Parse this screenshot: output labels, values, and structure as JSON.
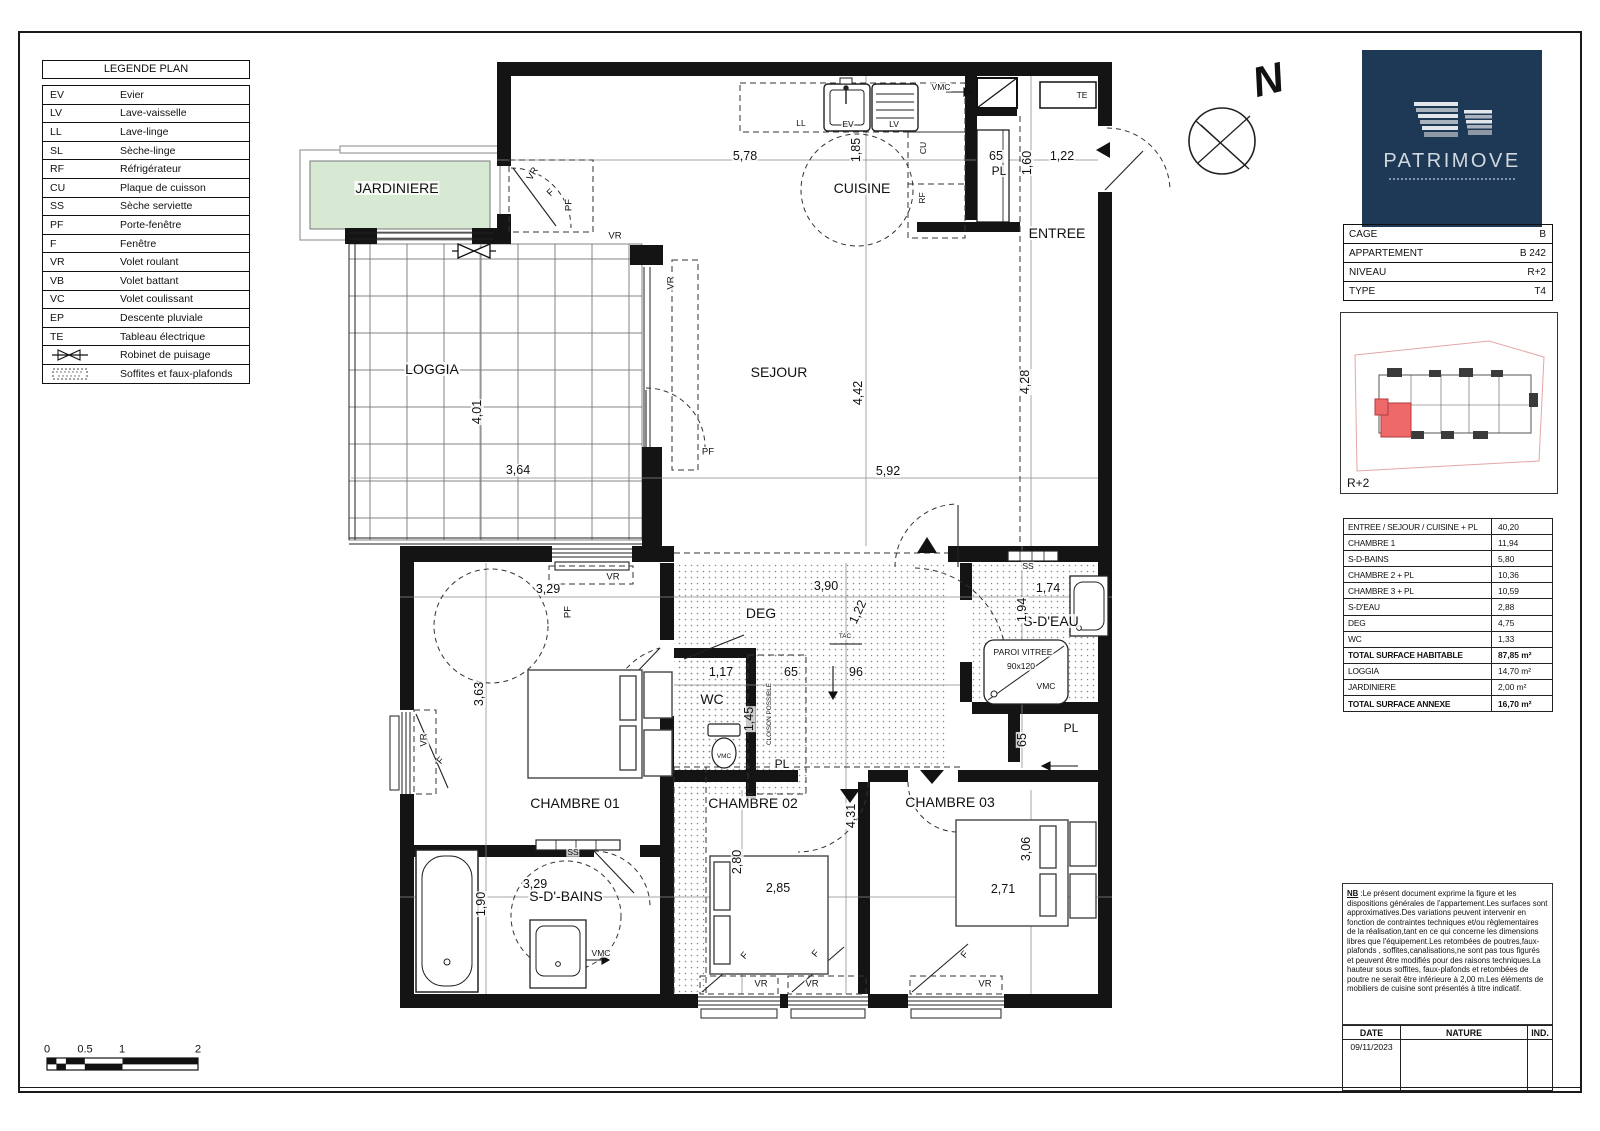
{
  "legend": {
    "title": "LEGENDE PLAN",
    "rows": [
      {
        "code": "EV",
        "label": "Evier"
      },
      {
        "code": "LV",
        "label": "Lave-vaisselle"
      },
      {
        "code": "LL",
        "label": "Lave-linge"
      },
      {
        "code": "SL",
        "label": "Sèche-linge"
      },
      {
        "code": "RF",
        "label": "Réfrigérateur"
      },
      {
        "code": "CU",
        "label": "Plaque de cuisson"
      },
      {
        "code": "SS",
        "label": "Sèche serviette"
      },
      {
        "code": "PF",
        "label": "Porte-fenêtre"
      },
      {
        "code": "F",
        "label": "Fenêtre"
      },
      {
        "code": "VR",
        "label": "Volet roulant"
      },
      {
        "code": "VB",
        "label": "Volet battant"
      },
      {
        "code": "VC",
        "label": "Volet coulissant"
      },
      {
        "code": "EP",
        "label": "Descente pluviale"
      },
      {
        "code": "TE",
        "label": "Tableau électrique"
      }
    ],
    "robinet_label": "Robinet de puisage",
    "soffites_label": "Soffites et faux-plafonds"
  },
  "compass": {
    "letter": "N"
  },
  "logo": {
    "brand": "PATRIMOVE"
  },
  "info": {
    "rows": [
      {
        "label": "CAGE",
        "value": "B"
      },
      {
        "label": "APPARTEMENT",
        "value": "B 242"
      },
      {
        "label": "NIVEAU",
        "value": "R+2"
      },
      {
        "label": "TYPE",
        "value": "T4"
      }
    ]
  },
  "keyplan": {
    "level": "R+2"
  },
  "surfaces": {
    "rows": [
      {
        "label": "ENTREE / SEJOUR / CUISINE + PL",
        "value": "40,20"
      },
      {
        "label": "CHAMBRE 1",
        "value": "11,94"
      },
      {
        "label": "S-D-BAINS",
        "value": "5,80"
      },
      {
        "label": "CHAMBRE 2 + PL",
        "value": "10,36"
      },
      {
        "label": "CHAMBRE 3 + PL",
        "value": "10,59"
      },
      {
        "label": "S-D'EAU",
        "value": "2,88"
      },
      {
        "label": "DEG",
        "value": "4,75"
      },
      {
        "label": "WC",
        "value": "1,33"
      },
      {
        "label": "TOTAL SURFACE HABITABLE",
        "value": "87,85 m²",
        "cls": "b"
      },
      {
        "label": "LOGGIA",
        "value": "14,70 m²"
      },
      {
        "label": "JARDINIERE",
        "value": "2,00 m²"
      },
      {
        "label": "TOTAL SURFACE ANNEXE",
        "value": "16,70 m²",
        "cls": "b"
      }
    ]
  },
  "nb": {
    "prefix": "NB",
    "text": " :Le présent document exprime la figure et les dispositions générales de l'appartement.Les surfaces sont approximatives.Des variations peuvent intervenir en fonction de contraintes techniques et/ou règlementaires de la réalisation,tant en ce qui concerne les dimensions libres que l'équipement.Les retombées de poutres,faux-plafonds , soffites,canalisations,ne sont pas tous figurés et peuvent être modifiés pour des raisons techniques.La hauteur sous soffites, faux-plafonds et retombées de poutre ne serait être inférieure à 2,00 m.Les éléments de mobiliers de cuisine sont présentés à titre indicatif."
  },
  "revisions": {
    "headers": [
      "DATE",
      "NATURE",
      "IND."
    ],
    "date": "09/11/2023"
  },
  "scalebar": {
    "ticks": [
      {
        "t": "0",
        "x": 47,
        "y": 1050
      },
      {
        "t": "0.5",
        "x": 85,
        "y": 1050
      },
      {
        "t": "1",
        "x": 122,
        "y": 1050
      },
      {
        "t": "2",
        "x": 198,
        "y": 1050
      }
    ]
  },
  "plan": {
    "labels": [
      {
        "t": "JARDINIERE",
        "x": 397,
        "y": 188,
        "c": "room"
      },
      {
        "t": "CUISINE",
        "x": 862,
        "y": 188,
        "c": "room"
      },
      {
        "t": "ENTREE",
        "x": 1057,
        "y": 233,
        "c": "room"
      },
      {
        "t": "SEJOUR",
        "x": 779,
        "y": 372,
        "c": "room"
      },
      {
        "t": "LOGGIA",
        "x": 432,
        "y": 369,
        "c": "room"
      },
      {
        "t": "DEG",
        "x": 761,
        "y": 613,
        "c": "room"
      },
      {
        "t": "S-D'EAU",
        "x": 1051,
        "y": 621,
        "c": "room"
      },
      {
        "t": "WC",
        "x": 712,
        "y": 699,
        "c": "room"
      },
      {
        "t": "CHAMBRE 01",
        "x": 575,
        "y": 803,
        "c": "room"
      },
      {
        "t": "CHAMBRE 02",
        "x": 753,
        "y": 803,
        "c": "room"
      },
      {
        "t": "CHAMBRE 03",
        "x": 950,
        "y": 802,
        "c": "room"
      },
      {
        "t": "S-D'-BAINS",
        "x": 566,
        "y": 896,
        "c": "room"
      },
      {
        "t": "PL",
        "x": 999,
        "y": 171,
        "c": "rsm"
      },
      {
        "t": "PL",
        "x": 782,
        "y": 764,
        "c": "rsm"
      },
      {
        "t": "PL",
        "x": 1071,
        "y": 728,
        "c": "rsm"
      },
      {
        "t": "5,78",
        "x": 745,
        "y": 156,
        "c": "dim"
      },
      {
        "t": "1,85",
        "x": 856,
        "y": 150,
        "r": -90,
        "c": "dim"
      },
      {
        "t": "65",
        "x": 996,
        "y": 156,
        "c": "dim"
      },
      {
        "t": "1,60",
        "x": 1027,
        "y": 163,
        "r": -90,
        "c": "dim"
      },
      {
        "t": "1,22",
        "x": 1062,
        "y": 156,
        "c": "dim"
      },
      {
        "t": "4,42",
        "x": 858,
        "y": 393,
        "r": -90,
        "c": "dim"
      },
      {
        "t": "4,28",
        "x": 1025,
        "y": 382,
        "r": -90,
        "c": "dim"
      },
      {
        "t": "5,92",
        "x": 888,
        "y": 471,
        "c": "dim"
      },
      {
        "t": "4,01",
        "x": 477,
        "y": 412,
        "r": -90,
        "c": "dim"
      },
      {
        "t": "3,64",
        "x": 518,
        "y": 470,
        "c": "dim"
      },
      {
        "t": "3,29",
        "x": 548,
        "y": 589,
        "c": "dim"
      },
      {
        "t": "3,63",
        "x": 479,
        "y": 694,
        "r": -90,
        "c": "dim"
      },
      {
        "t": "3,90",
        "x": 826,
        "y": 586,
        "c": "dim"
      },
      {
        "t": "1,22",
        "x": 858,
        "y": 612,
        "r": -65,
        "c": "dim"
      },
      {
        "t": "1,74",
        "x": 1048,
        "y": 588,
        "c": "dim"
      },
      {
        "t": "1,94",
        "x": 1022,
        "y": 610,
        "r": -90,
        "c": "dim"
      },
      {
        "t": "1,17",
        "x": 721,
        "y": 672,
        "c": "dim"
      },
      {
        "t": "65",
        "x": 791,
        "y": 672,
        "c": "dim"
      },
      {
        "t": "96",
        "x": 856,
        "y": 672,
        "c": "dim"
      },
      {
        "t": "1,45",
        "x": 749,
        "y": 719,
        "r": -90,
        "c": "dim"
      },
      {
        "t": "65",
        "x": 1022,
        "y": 740,
        "r": -90,
        "c": "dim"
      },
      {
        "t": "3,29",
        "x": 535,
        "y": 884,
        "c": "dim"
      },
      {
        "t": "1,90",
        "x": 481,
        "y": 904,
        "r": -90,
        "c": "dim"
      },
      {
        "t": "2,80",
        "x": 737,
        "y": 862,
        "r": -90,
        "c": "dim"
      },
      {
        "t": "2,85",
        "x": 778,
        "y": 888,
        "c": "dim"
      },
      {
        "t": "4,31",
        "x": 851,
        "y": 816,
        "r": -90,
        "c": "dim"
      },
      {
        "t": "3,06",
        "x": 1026,
        "y": 849,
        "r": -90,
        "c": "dim"
      },
      {
        "t": "2,71",
        "x": 1003,
        "y": 889,
        "c": "dim"
      },
      {
        "t": "LL",
        "x": 801,
        "y": 123,
        "c": "sm"
      },
      {
        "t": "EV",
        "x": 848,
        "y": 124,
        "c": "sm"
      },
      {
        "t": "LV",
        "x": 894,
        "y": 124,
        "c": "sm"
      },
      {
        "t": "CU",
        "x": 923,
        "y": 148,
        "r": -90,
        "c": "sm"
      },
      {
        "t": "RF",
        "x": 922,
        "y": 198,
        "r": -90,
        "c": "sm"
      },
      {
        "t": "VMC",
        "x": 941,
        "y": 87,
        "c": "sm"
      },
      {
        "t": "TE",
        "x": 1082,
        "y": 95,
        "c": "sm"
      },
      {
        "t": "SS",
        "x": 1028,
        "y": 566,
        "c": "sm"
      },
      {
        "t": "SS",
        "x": 573,
        "y": 852,
        "c": "sm"
      },
      {
        "t": "VMC",
        "x": 1046,
        "y": 686,
        "c": "sm"
      },
      {
        "t": "VMC",
        "x": 601,
        "y": 953,
        "c": "sm"
      },
      {
        "t": "VMC",
        "x": 724,
        "y": 757,
        "c": "tiny"
      },
      {
        "t": "TAC",
        "x": 845,
        "y": 637,
        "c": "tiny"
      },
      {
        "t": "PAROI VITREE",
        "x": 1023,
        "y": 652,
        "c": "sm"
      },
      {
        "t": "90x120",
        "x": 1021,
        "y": 666,
        "c": "sm"
      },
      {
        "t": "CLOISON POSSIBLE",
        "x": 770,
        "y": 714,
        "r": -90,
        "c": "tiny"
      },
      {
        "t": "VR",
        "x": 533,
        "y": 174,
        "r": -60,
        "c": "vf"
      },
      {
        "t": "F",
        "x": 551,
        "y": 193,
        "r": -45,
        "c": "vf"
      },
      {
        "t": "PF",
        "x": 569,
        "y": 205,
        "r": -90,
        "c": "vf"
      },
      {
        "t": "VR",
        "x": 615,
        "y": 236,
        "c": "vf"
      },
      {
        "t": "VR",
        "x": 671,
        "y": 283,
        "r": -90,
        "c": "vf"
      },
      {
        "t": "PF",
        "x": 708,
        "y": 452,
        "c": "vf"
      },
      {
        "t": "VR",
        "x": 613,
        "y": 577,
        "c": "vf"
      },
      {
        "t": "PF",
        "x": 568,
        "y": 612,
        "r": -90,
        "c": "vf"
      },
      {
        "t": "VR",
        "x": 424,
        "y": 740,
        "r": -90,
        "c": "vf"
      },
      {
        "t": "F",
        "x": 441,
        "y": 761,
        "r": -50,
        "c": "vf"
      },
      {
        "t": "F",
        "x": 745,
        "y": 956,
        "r": -50,
        "c": "vf"
      },
      {
        "t": "VR",
        "x": 761,
        "y": 984,
        "c": "vf"
      },
      {
        "t": "F",
        "x": 816,
        "y": 954,
        "r": -50,
        "c": "vf"
      },
      {
        "t": "VR",
        "x": 812,
        "y": 984,
        "c": "vf"
      },
      {
        "t": "F",
        "x": 965,
        "y": 955,
        "r": -50,
        "c": "vf"
      },
      {
        "t": "VR",
        "x": 985,
        "y": 984,
        "c": "vf"
      },
      {
        "t": "N",
        "x": 1268,
        "y": 80,
        "r": -14,
        "c": "north"
      }
    ]
  }
}
